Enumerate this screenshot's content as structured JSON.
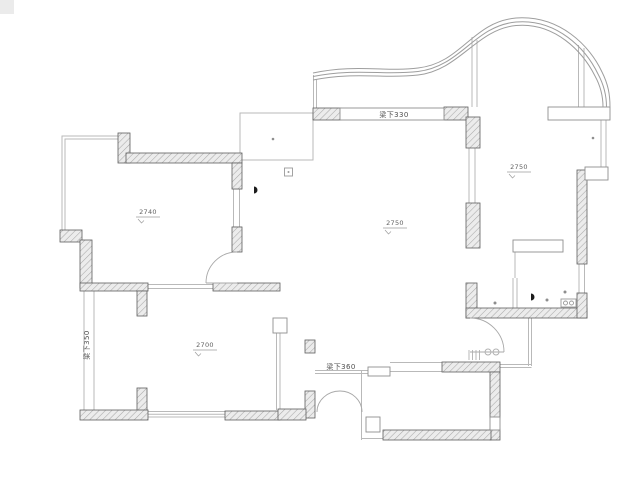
{
  "drawing": {
    "type": "residential floor plan"
  },
  "rooms": [
    {
      "name": "bedroom-top-left",
      "ceiling_height": "2740"
    },
    {
      "name": "living-dining-room",
      "ceiling_height": "2750"
    },
    {
      "name": "bedroom-right",
      "ceiling_height": "2750"
    },
    {
      "name": "bedroom-bottom-left",
      "ceiling_height": "2700"
    }
  ],
  "beams": [
    {
      "name": "beam-top-living",
      "label": "梁下330"
    },
    {
      "name": "beam-left-wall",
      "label": "梁下350"
    },
    {
      "name": "beam-dining",
      "label": "梁下360"
    }
  ],
  "colors": {
    "background": "#ffffff",
    "wall_hatch_fill": "#ececec",
    "wall_hatch_line": "#a9a9a9",
    "wall_stroke": "#5e5e5e",
    "light_line": "#b9b9b9",
    "curve_line": "#9e9e9e",
    "text": "#5f5f5f"
  },
  "icons": [
    {
      "name": "wall-light-icon"
    },
    {
      "name": "doorbell-panel-icon"
    },
    {
      "name": "basin-icon"
    },
    {
      "name": "entry-mat-icon"
    }
  ]
}
